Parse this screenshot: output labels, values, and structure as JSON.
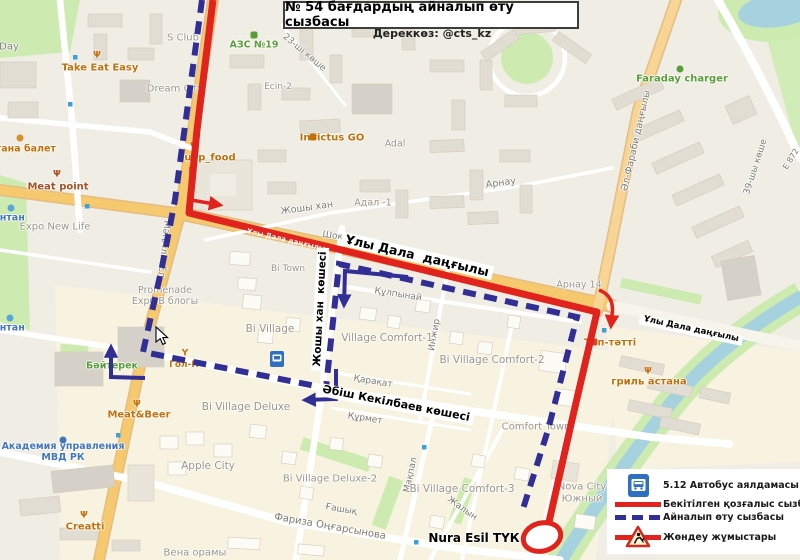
{
  "page": {
    "title": "№ 54 бағдардың айналып өту сызбасы",
    "source": "Дереккөз: @cts_kz"
  },
  "legend": {
    "items": [
      {
        "icon": "bus-stop-sign-icon",
        "label": "5.12 Автобус аялдамасы"
      },
      {
        "icon": "approved-route-line",
        "label": "Бекітілген қозғалыс сызбасы"
      },
      {
        "icon": "detour-route-line",
        "label": "Айналып өту сызбасы"
      },
      {
        "icon": "roadworks-sign-icon",
        "label": "Жөндеу жұмыстары"
      }
    ]
  },
  "colors": {
    "approved_route": "#e0231d",
    "detour_route": "#312e96",
    "major_road": "#f6c96e",
    "water": "#a6d1de",
    "green": "#cdebb0"
  },
  "annotations": [
    {
      "t": "Ұлы Дала  даңғылы",
      "x": 417,
      "y": 256,
      "r": 13,
      "c": "annot",
      "s": 12.5
    },
    {
      "t": "Ұлы Дала даңғылы",
      "x": 691,
      "y": 330,
      "r": 12,
      "c": "annot",
      "s": 8.5
    },
    {
      "t": "Жошы хан  көшесі",
      "x": 320,
      "y": 309,
      "r": -87,
      "c": "annot",
      "s": 10.5
    },
    {
      "t": "Әбіш Кекілбаев көшесі",
      "x": 396,
      "y": 404,
      "r": 11,
      "c": "annot",
      "s": 11
    },
    {
      "t": "Nura Esil ТҮК",
      "x": 474,
      "y": 539,
      "r": 0,
      "c": "plain",
      "s": 12
    },
    {
      "t": "Ұлы Дала даңғылы",
      "x": 286,
      "y": 240,
      "r": 13,
      "c": "onred",
      "s": 7
    }
  ],
  "map_labels": [
    {
      "t": "Day",
      "x": 9,
      "y": 47,
      "c": "street",
      "s": 10
    },
    {
      "t": "Take Eat Easy",
      "x": 100,
      "y": 68,
      "c": "orange"
    },
    {
      "t": "S Club",
      "x": 183,
      "y": 38,
      "c": "area"
    },
    {
      "t": "АЗС №19",
      "x": 254,
      "y": 46,
      "c": "green",
      "s": 9.5
    },
    {
      "t": "Dream City",
      "x": 175,
      "y": 89,
      "c": "area"
    },
    {
      "t": "Ecin-2",
      "x": 278,
      "y": 87,
      "c": "area",
      "s": 9
    },
    {
      "t": "23-ші көше",
      "x": 304,
      "y": 53,
      "r": 40,
      "c": "street"
    },
    {
      "t": "Invictus GO",
      "x": 332,
      "y": 138,
      "c": "orange"
    },
    {
      "t": "Adal",
      "x": 395,
      "y": 145,
      "c": "area",
      "s": 9.5
    },
    {
      "t": "uap_food",
      "x": 210,
      "y": 158,
      "c": "orange"
    },
    {
      "t": "Адал -1",
      "x": 373,
      "y": 204,
      "c": "area",
      "s": 9.5
    },
    {
      "t": "Арнау",
      "x": 501,
      "y": 184,
      "r": -8,
      "c": "street",
      "s": 9.5
    },
    {
      "t": "Жошы хан",
      "x": 307,
      "y": 209,
      "r": -8,
      "c": "street",
      "s": 9.5
    },
    {
      "t": "Шоқжұлдыз",
      "x": 351,
      "y": 239,
      "r": 8,
      "c": "street"
    },
    {
      "t": "Faraday charger",
      "x": 682,
      "y": 79,
      "c": "green"
    },
    {
      "t": "Әл-Фараби даңғылы",
      "x": 637,
      "y": 141,
      "r": -77,
      "c": "street",
      "s": 9.5
    },
    {
      "t": "39-шы көше",
      "x": 756,
      "y": 167,
      "r": -72,
      "c": "street"
    },
    {
      "t": "Е 872",
      "x": 791,
      "y": 159,
      "r": -58,
      "c": "street",
      "s": 8
    },
    {
      "t": "Арнау 14",
      "x": 579,
      "y": 286,
      "c": "area",
      "s": 9.5
    },
    {
      "t": "стана балет",
      "x": 23,
      "y": 150,
      "c": "orange",
      "s": 9.5
    },
    {
      "t": "Meat point",
      "x": 58,
      "y": 187,
      "c": "brown"
    },
    {
      "t": "онтан",
      "x": 9,
      "y": 219,
      "c": "blue"
    },
    {
      "t": "Expo New Life",
      "x": 55,
      "y": 227,
      "c": "area"
    },
    {
      "t": "Мәңгілік Ел",
      "x": 163,
      "y": 249,
      "r": 96,
      "c": "street",
      "s": 9.5
    },
    {
      "t": "Bi Town",
      "x": 288,
      "y": 269,
      "c": "area",
      "s": 9
    },
    {
      "t": "Promenade\nExpo В блогы",
      "x": 165,
      "y": 297,
      "c": "area",
      "s": 9.5
    },
    {
      "t": "онтан",
      "x": 9,
      "y": 329,
      "c": "blue"
    },
    {
      "t": "Bi Village",
      "x": 270,
      "y": 329,
      "c": "area",
      "s": 10.5
    },
    {
      "t": "Құлпынай",
      "x": 398,
      "y": 295,
      "r": 9,
      "c": "street"
    },
    {
      "t": "Инжир",
      "x": 435,
      "y": 335,
      "r": -80,
      "c": "street"
    },
    {
      "t": "Village Comfort-1",
      "x": 387,
      "y": 338,
      "c": "area",
      "s": 10.5
    },
    {
      "t": "Bi Village Comfort-2",
      "x": 492,
      "y": 360,
      "c": "area",
      "s": 10.5
    },
    {
      "t": "Бәйтерек",
      "x": 112,
      "y": 367,
      "c": "green",
      "s": 9.5
    },
    {
      "t": "Гол-П",
      "x": 184,
      "y": 365,
      "c": "orange",
      "s": 9
    },
    {
      "t": "Қарақат",
      "x": 373,
      "y": 382,
      "r": 9,
      "c": "street"
    },
    {
      "t": "Тәп-тәтті",
      "x": 610,
      "y": 343,
      "c": "orange"
    },
    {
      "t": "гриль астана",
      "x": 649,
      "y": 382,
      "c": "orange"
    },
    {
      "t": "Meat&Beer",
      "x": 139,
      "y": 415,
      "c": "orange"
    },
    {
      "t": "Bi Village Deluxe",
      "x": 246,
      "y": 407,
      "c": "area",
      "s": 10.5
    },
    {
      "t": "Құрмет",
      "x": 365,
      "y": 419,
      "r": 9,
      "c": "street"
    },
    {
      "t": "Comfort Town",
      "x": 536,
      "y": 427,
      "c": "area"
    },
    {
      "t": "Академия управления\nМВД РК",
      "x": 63,
      "y": 453,
      "c": "blue"
    },
    {
      "t": "Apple City",
      "x": 208,
      "y": 466,
      "c": "area",
      "s": 10.5
    },
    {
      "t": "Мақпал",
      "x": 411,
      "y": 475,
      "r": -78,
      "c": "street"
    },
    {
      "t": "Bi Village Deluxe-2",
      "x": 330,
      "y": 479,
      "c": "area",
      "s": 10
    },
    {
      "t": "Bi Village Comfort-3",
      "x": 462,
      "y": 489,
      "c": "area",
      "s": 10.5
    },
    {
      "t": "Nova City\nЮжный",
      "x": 582,
      "y": 493,
      "c": "area"
    },
    {
      "t": "Ғашық",
      "x": 341,
      "y": 510,
      "r": 10,
      "c": "street"
    },
    {
      "t": "Жалын",
      "x": 462,
      "y": 509,
      "r": 35,
      "c": "street"
    },
    {
      "t": "Creatti",
      "x": 85,
      "y": 527,
      "c": "orange"
    },
    {
      "t": "Фариза Оңғарсынова",
      "x": 330,
      "y": 527,
      "r": 10,
      "c": "street",
      "s": 10
    },
    {
      "t": "Вена орамы",
      "x": 195,
      "y": 553,
      "c": "area"
    }
  ],
  "poi_icons": [
    {
      "n": "restaurant-icon",
      "x": 97,
      "y": 56,
      "col": "#c2700a",
      "g": "Ψ"
    },
    {
      "n": "restaurant-icon",
      "x": 57,
      "y": 175,
      "col": "#a35224",
      "g": "Ψ"
    },
    {
      "n": "restaurant-icon",
      "x": 194,
      "y": 147,
      "col": "#c2700a",
      "g": "Ψ"
    },
    {
      "n": "restaurant-icon",
      "x": 137,
      "y": 405,
      "col": "#c2700a",
      "g": "Ψ"
    },
    {
      "n": "restaurant-icon",
      "x": 648,
      "y": 372,
      "col": "#c2700a",
      "g": "Ψ"
    },
    {
      "n": "restaurant-icon",
      "x": 84,
      "y": 516,
      "col": "#c2700a",
      "g": "Ψ"
    },
    {
      "n": "bar-icon",
      "x": 185,
      "y": 354,
      "col": "#c2700a",
      "g": "Y"
    },
    {
      "n": "scooter-icon",
      "x": 313,
      "y": 137,
      "col": "#c2700a",
      "sq": 1
    },
    {
      "n": "fuel-icon",
      "x": 254,
      "y": 35,
      "col": "#5a9e3c",
      "sq": 1
    },
    {
      "n": "charger-icon",
      "x": 680,
      "y": 69,
      "col": "#5a9e3c"
    },
    {
      "n": "ballet-icon",
      "x": 20,
      "y": 138,
      "col": "#d98f2b"
    },
    {
      "n": "fountain-icon",
      "x": 11,
      "y": 208,
      "col": "#58a7d8"
    },
    {
      "n": "fountain-icon",
      "x": 10,
      "y": 318,
      "col": "#58a7d8"
    },
    {
      "n": "academy-icon",
      "x": 63,
      "y": 440,
      "col": "#4277bd"
    },
    {
      "n": "monument-icon",
      "x": 112,
      "y": 355,
      "col": "#4e8c3f",
      "g": "▲"
    },
    {
      "n": "shop-icon",
      "x": 594,
      "y": 342,
      "col": "#d0482a",
      "sq": 1
    }
  ],
  "bus_stop_dots": [
    [
      75,
      57
    ],
    [
      70,
      104
    ],
    [
      87,
      206
    ],
    [
      152,
      300
    ],
    [
      118,
      435
    ],
    [
      424,
      447
    ],
    [
      416,
      542
    ],
    [
      604,
      330
    ]
  ]
}
